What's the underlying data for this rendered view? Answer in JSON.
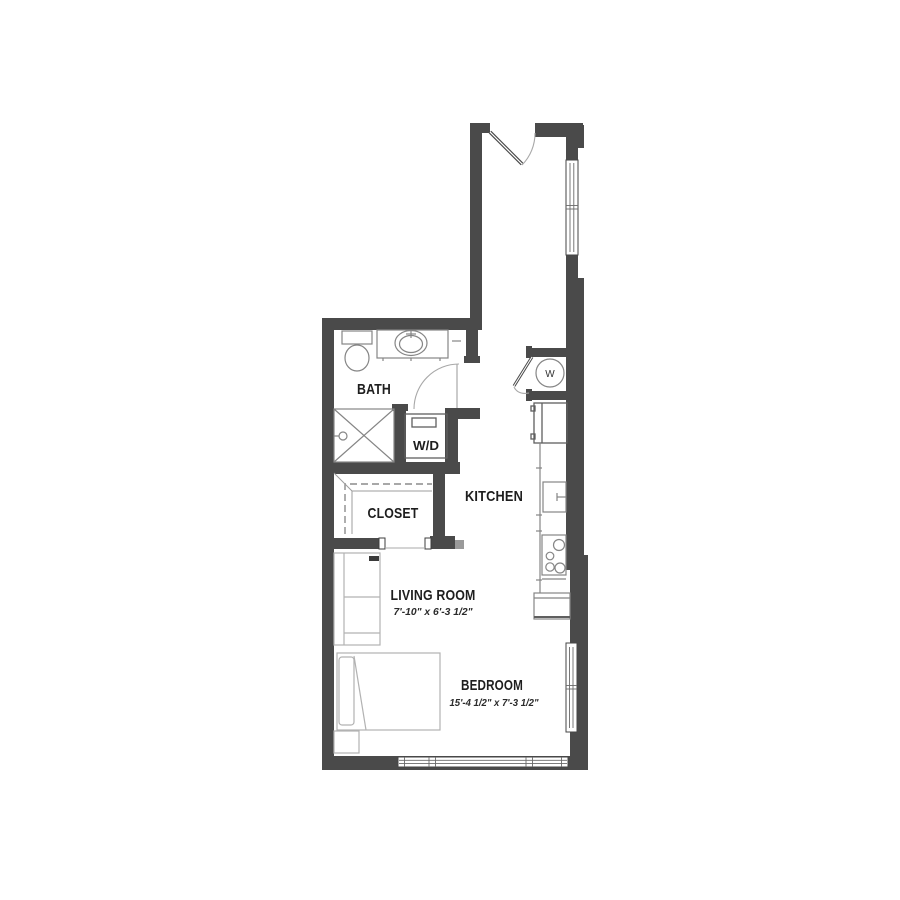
{
  "floorplan": {
    "type": "apartment-floor-plan",
    "background_color": "#ffffff",
    "wall_color": "#4a4a4a",
    "fixture_line_color": "#858585",
    "text_color": "#1e1e1e",
    "rooms": {
      "bath": {
        "label": "BATH"
      },
      "closet": {
        "label": "CLOSET"
      },
      "kitchen": {
        "label": "KITCHEN"
      },
      "living_room": {
        "label": "LIVING ROOM",
        "dimensions": "7'-10\" x 6'-3 1/2\""
      },
      "bedroom": {
        "label": "BEDROOM",
        "dimensions": "15'-4 1/2\" x 7'-3 1/2\""
      },
      "laundry": {
        "label": "W/D"
      },
      "water_heater": {
        "label": "W"
      }
    },
    "fixtures": [
      "entry-door",
      "bath-door",
      "toilet",
      "vanity-sink",
      "shower",
      "washer-dryer",
      "water-heater",
      "closet-rod-and-shelf",
      "refrigerator",
      "kitchen-sink",
      "range",
      "kitchen-counter",
      "sofa",
      "bed",
      "nightstand",
      "window"
    ]
  }
}
